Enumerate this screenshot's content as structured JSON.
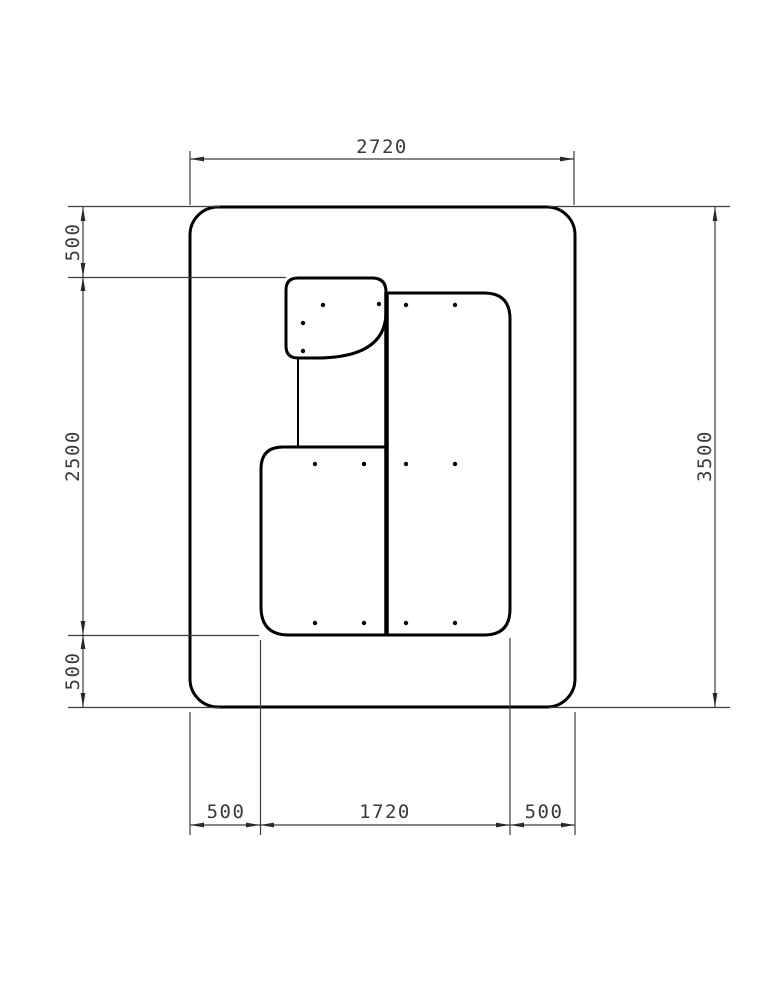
{
  "drawing": {
    "kind": "cad-plan-drawing",
    "colors": {
      "background": "#ffffff",
      "shape_line": "#000000",
      "dimension_line": "#3c3c3c",
      "dimension_text": "#3a3a3a"
    },
    "dims": {
      "top_width": "2720",
      "left_top_offset": "500",
      "left_inner_height": "2500",
      "left_bottom_offset": "500",
      "right_total_height": "3500",
      "bottom_left_offset": "500",
      "bottom_inner_width": "1720",
      "bottom_right_offset": "500"
    },
    "fastener_dot_count": 14
  }
}
